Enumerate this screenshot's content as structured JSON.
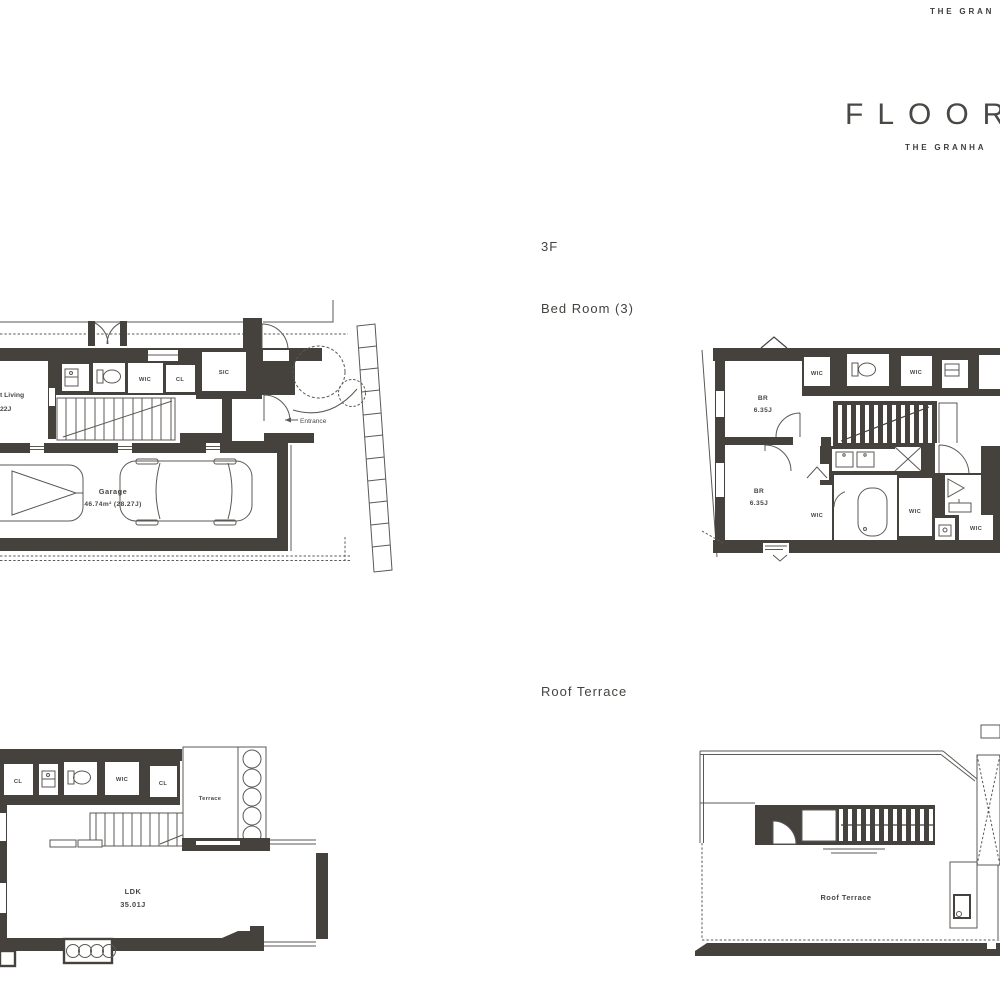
{
  "header": {
    "brand_top": "THE GRAN",
    "title": "FLOOR",
    "subtitle": "THE GRANHA"
  },
  "section_labels": {
    "floor": "3F",
    "bedroom": "Bed Room (3)",
    "roof_terrace": "Roof Terrace"
  },
  "plan_3f_left": {
    "living_line1": "t Living",
    "living_line2": "22J",
    "wic": "WIC",
    "cl": "CL",
    "sic": "SIC",
    "entrance": "Entrance",
    "garage": "Garage",
    "garage_area": "46.74m² (28.27J)"
  },
  "plan_3f_right": {
    "br1": "BR",
    "br1_area": "6.35J",
    "br2": "BR",
    "br2_area": "6.35J",
    "wic_top_left": "WIC",
    "wic_top_right": "WIC",
    "wic_br2": "WIC",
    "wic_mid": "WIC",
    "wic_bottom": "WIC"
  },
  "plan_2f": {
    "cl1": "CL",
    "wic": "WIC",
    "cl2": "CL",
    "terrace": "Terrace",
    "ldk": "LDK",
    "ldk_area": "35.01J"
  },
  "plan_rf": {
    "roof_terrace": "Roof Terrace"
  },
  "colors": {
    "wall": "#45423d",
    "line": "#5b5954",
    "text": "#45433f"
  }
}
